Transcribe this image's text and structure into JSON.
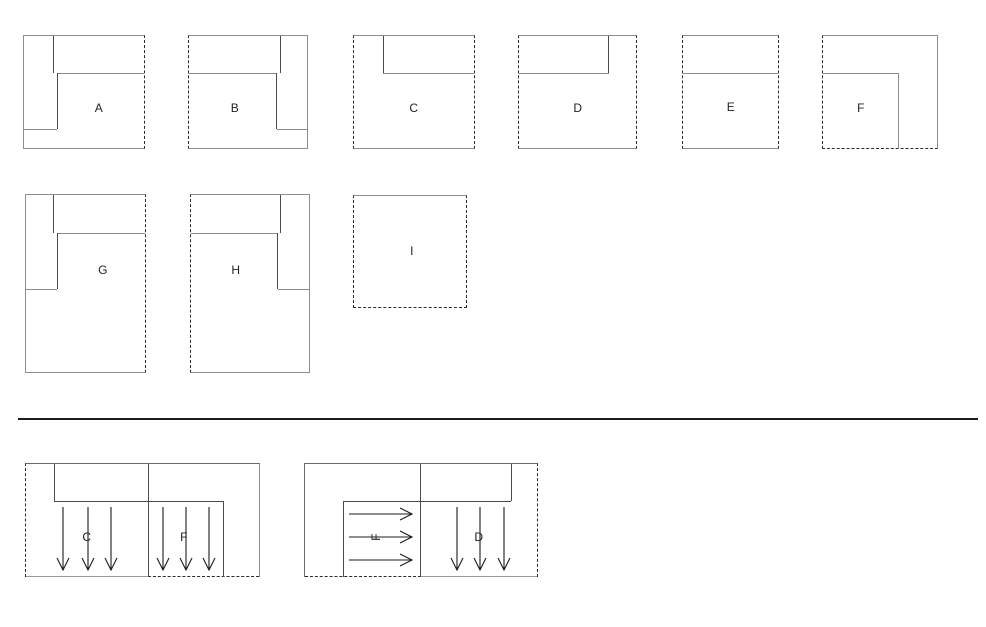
{
  "diagram": {
    "modules": {
      "a": {
        "label": "A"
      },
      "b": {
        "label": "B"
      },
      "c": {
        "label": "C"
      },
      "d": {
        "label": "D"
      },
      "e": {
        "label": "E"
      },
      "f": {
        "label": "F"
      },
      "g": {
        "label": "G"
      },
      "h": {
        "label": "H"
      },
      "i": {
        "label": "I"
      }
    },
    "combinations": {
      "combo1": {
        "first": "C",
        "second": "F",
        "first_arrows": "down",
        "second_arrows": "down"
      },
      "combo2": {
        "first": "F",
        "second": "D",
        "first_arrows": "right",
        "second_arrows": "down"
      }
    },
    "colors": {
      "outline_solid": "#8c8c8c",
      "outline_dashed": "#2b2b2b",
      "inner_line": "#4a4a4a",
      "arrow": "#1c1c1c",
      "divider": "#1c1c1c",
      "label": "#222222",
      "background": "#ffffff"
    }
  }
}
